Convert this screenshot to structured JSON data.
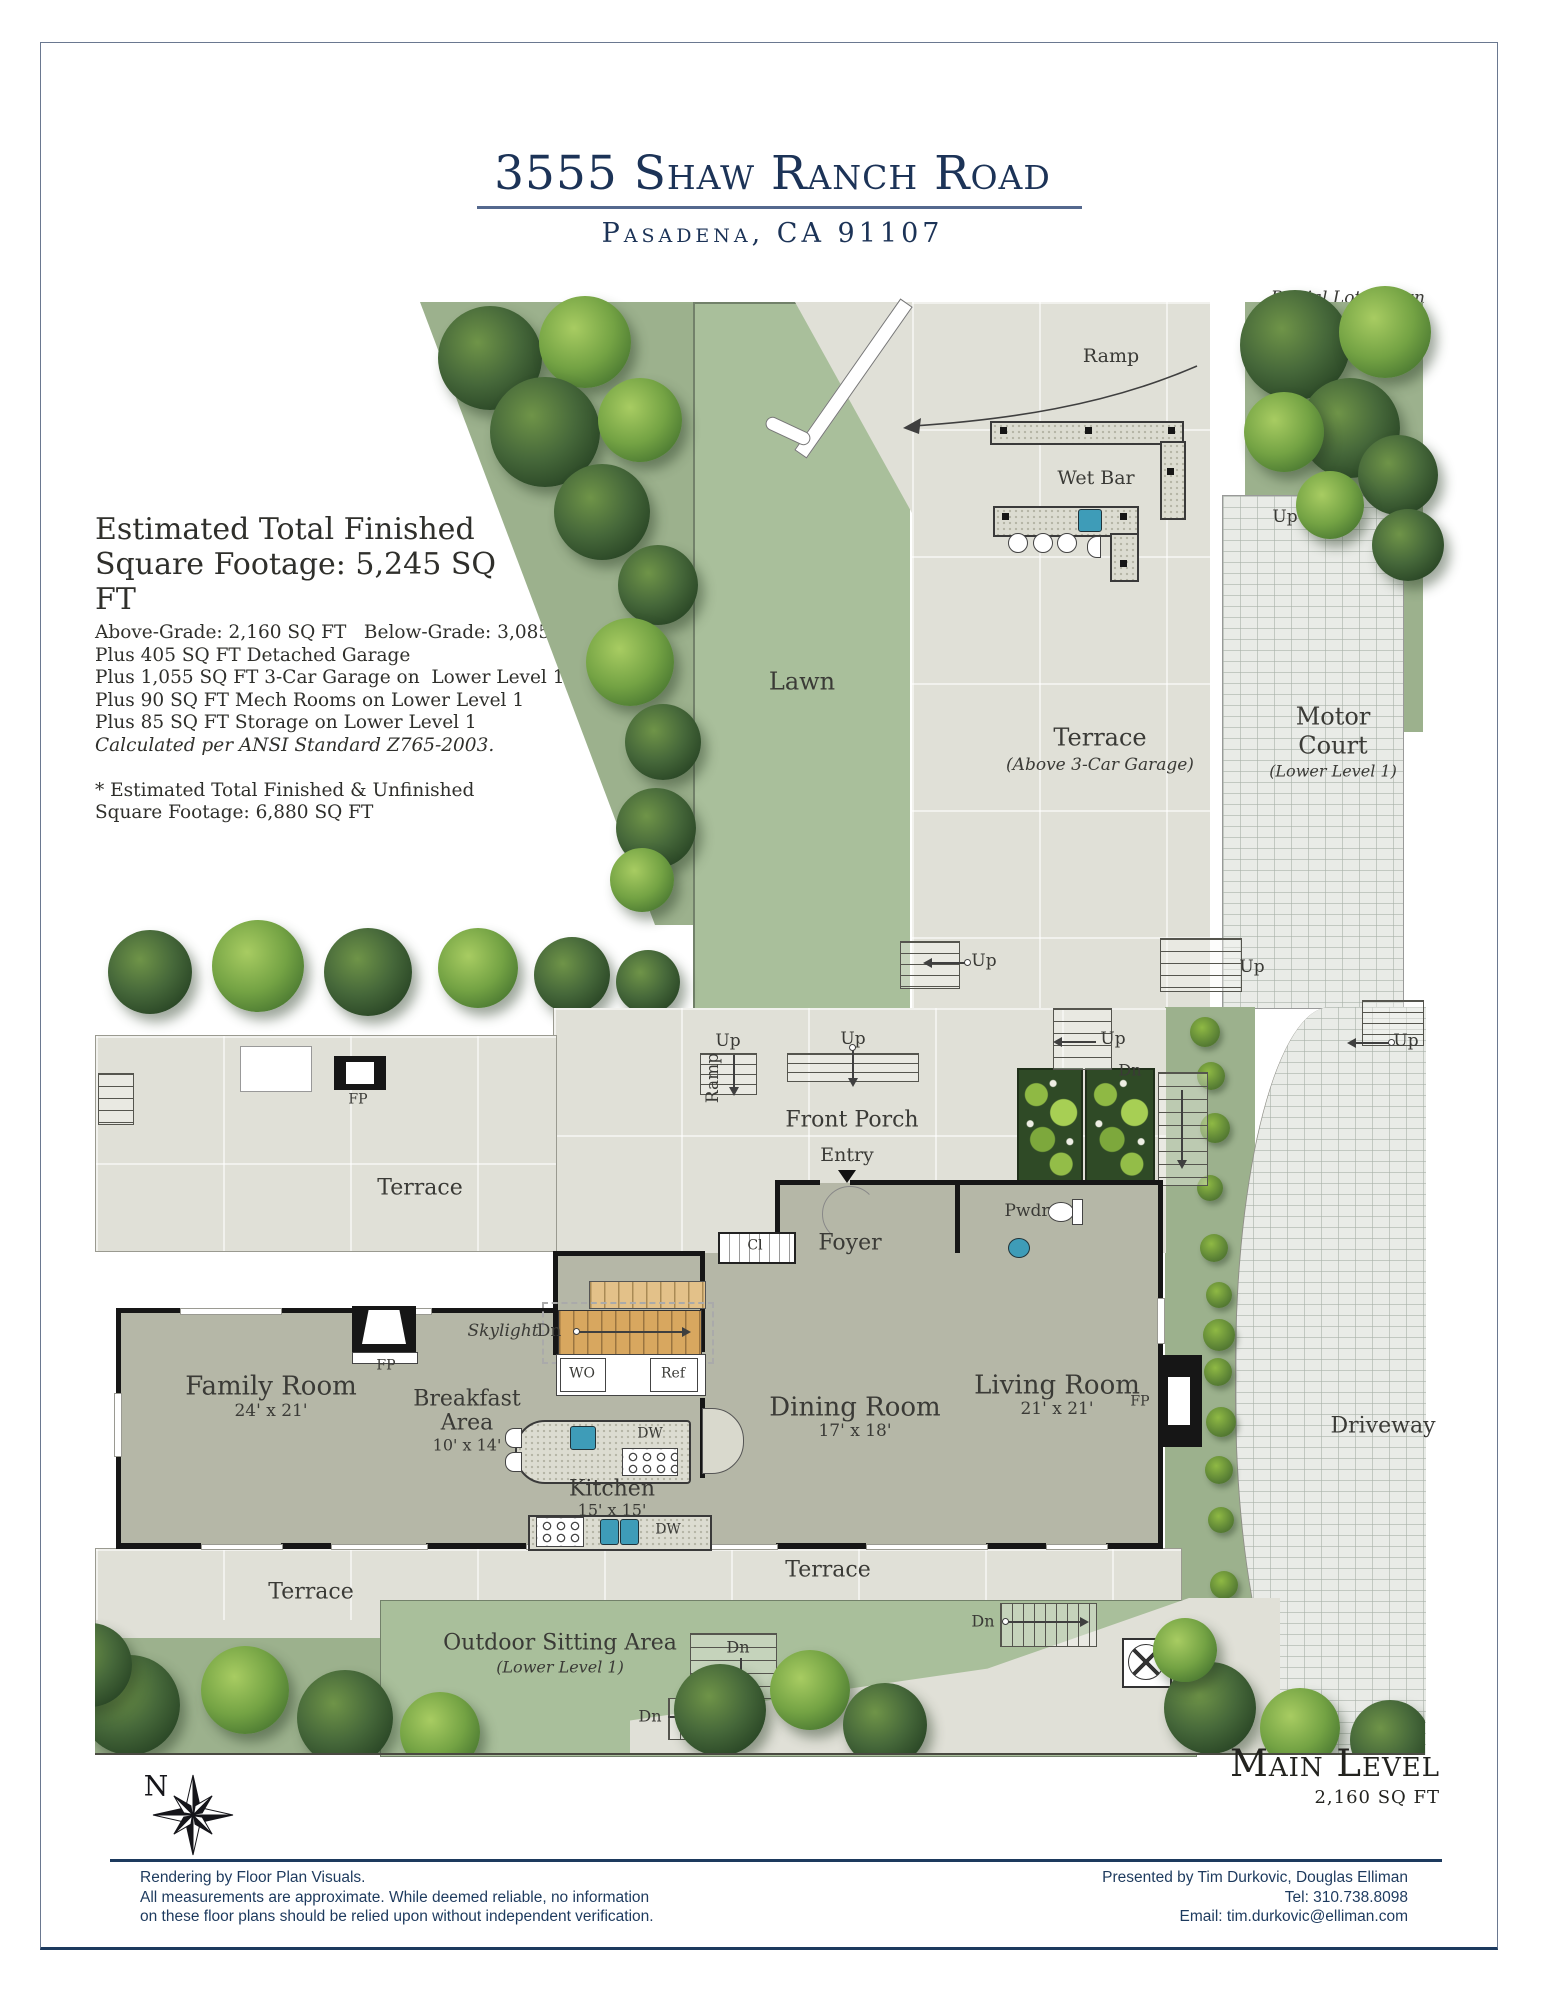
{
  "header": {
    "address": "3555 Shaw Ranch Road",
    "city_line": "Pasadena, CA 91107",
    "partial_lot_note": "Partial Lot Shown"
  },
  "sqft_summary": {
    "heading_line1": "Estimated Total Finished",
    "heading_line2": "Square Footage: 5,245 SQ FT",
    "detail_lines": [
      "Above-Grade: 2,160 SQ FT   Below-Grade: 3,085 SQ FT",
      "Plus 405 SQ FT Detached Garage",
      "Plus 1,055 SQ FT 3-Car Garage on  Lower Level 1",
      "Plus 90 SQ FT Mech Rooms on Lower Level 1",
      "Plus 85 SQ FT Storage on Lower Level 1"
    ],
    "ansi_note": "Calculated per ANSI Standard Z765-2003.",
    "footnote_line1": "* Estimated Total Finished & Unfinished",
    "footnote_line2": "Square Footage: 6,880 SQ FT"
  },
  "level": {
    "name": "Main Level",
    "sqft": "2,160 SQ FT"
  },
  "compass": {
    "north": "N"
  },
  "plan": {
    "areas": {
      "lawn": "Lawn",
      "wet_bar": "Wet Bar",
      "terrace": "Terrace",
      "terrace_garage_note": "(Above 3-Car Garage)",
      "motor_line1": "Motor",
      "motor_line2": "Court",
      "motor_note": "(Lower Level 1)",
      "front_porch": "Front Porch",
      "entry": "Entry",
      "foyer": "Foyer",
      "pwdr": "Pwdr",
      "closet": "Cl",
      "driveway": "Driveway",
      "outdoor_sitting": "Outdoor Sitting Area",
      "outdoor_note": "(Lower Level 1)",
      "skylight": "Skylight"
    },
    "rooms": {
      "family": {
        "name": "Family Room",
        "dims": "24' x 21'"
      },
      "breakfast": {
        "line1": "Breakfast",
        "line2": "Area",
        "dims": "10' x 14'"
      },
      "kitchen": {
        "name": "Kitchen",
        "dims": "15' x 15'"
      },
      "dining": {
        "name": "Dining Room",
        "dims": "17' x 18'"
      },
      "living": {
        "name": "Living Room",
        "dims": "21' x 21'"
      }
    },
    "markers": {
      "up": "Up",
      "dn": "Dn",
      "ramp": "Ramp",
      "fp": "FP",
      "dw": "DW",
      "wo": "WO",
      "ref": "Ref"
    }
  },
  "footer": {
    "left_lines": [
      "Rendering by Floor Plan Visuals.",
      "All measurements are approximate. While deemed reliable, no information",
      "on these floor plans should be relied upon without independent verification."
    ],
    "right_lines": [
      "Presented by Tim Durkovic, Douglas Elliman",
      "Tel: 310.738.8098",
      "Email: tim.durkovic@elliman.com"
    ]
  },
  "colors": {
    "navy": "#1d3a5e",
    "lawn_green": "#a9bf9b",
    "hardscape": "#e0e0d7",
    "floor": "#b5b7a7",
    "fixture_blue": "#3e9cb8"
  }
}
